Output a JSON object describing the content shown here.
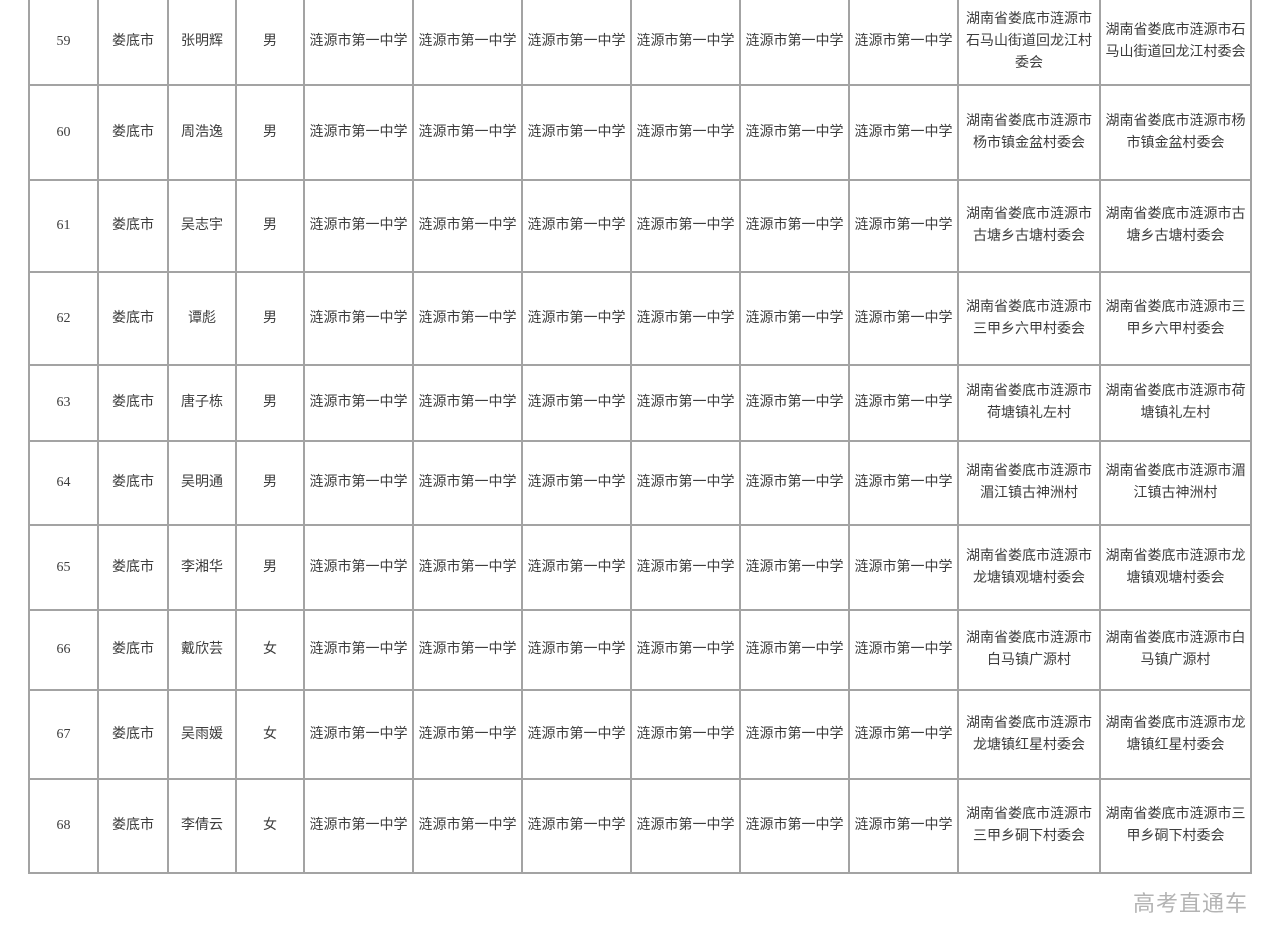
{
  "colors": {
    "border": "#a3a3a3",
    "text": "#3d3d3d",
    "watermark": "#b3b3b3",
    "background": "#ffffff"
  },
  "watermark": "高考直通车",
  "table": {
    "rows": [
      {
        "seq": "59",
        "city": "娄底市",
        "name": "张明辉",
        "gender": "男",
        "school": "涟源市第一中学",
        "address": "湖南省娄底市涟源市石马山街道回龙江村委会"
      },
      {
        "seq": "60",
        "city": "娄底市",
        "name": "周浩逸",
        "gender": "男",
        "school": "涟源市第一中学",
        "address": "湖南省娄底市涟源市杨市镇金盆村委会"
      },
      {
        "seq": "61",
        "city": "娄底市",
        "name": "吴志宇",
        "gender": "男",
        "school": "涟源市第一中学",
        "address": "湖南省娄底市涟源市古塘乡古塘村委会"
      },
      {
        "seq": "62",
        "city": "娄底市",
        "name": "谭彪",
        "gender": "男",
        "school": "涟源市第一中学",
        "address": "湖南省娄底市涟源市三甲乡六甲村委会"
      },
      {
        "seq": "63",
        "city": "娄底市",
        "name": "唐子栋",
        "gender": "男",
        "school": "涟源市第一中学",
        "address": "湖南省娄底市涟源市荷塘镇礼左村"
      },
      {
        "seq": "64",
        "city": "娄底市",
        "name": "吴明通",
        "gender": "男",
        "school": "涟源市第一中学",
        "address": "湖南省娄底市涟源市湄江镇古神洲村"
      },
      {
        "seq": "65",
        "city": "娄底市",
        "name": "李湘华",
        "gender": "男",
        "school": "涟源市第一中学",
        "address": "湖南省娄底市涟源市龙塘镇观塘村委会"
      },
      {
        "seq": "66",
        "city": "娄底市",
        "name": "戴欣芸",
        "gender": "女",
        "school": "涟源市第一中学",
        "address": "湖南省娄底市涟源市白马镇广源村"
      },
      {
        "seq": "67",
        "city": "娄底市",
        "name": "吴雨媛",
        "gender": "女",
        "school": "涟源市第一中学",
        "address": "湖南省娄底市涟源市龙塘镇红星村委会"
      },
      {
        "seq": "68",
        "city": "娄底市",
        "name": "李倩云",
        "gender": "女",
        "school": "涟源市第一中学",
        "address": "湖南省娄底市涟源市三甲乡硐下村委会"
      }
    ]
  }
}
